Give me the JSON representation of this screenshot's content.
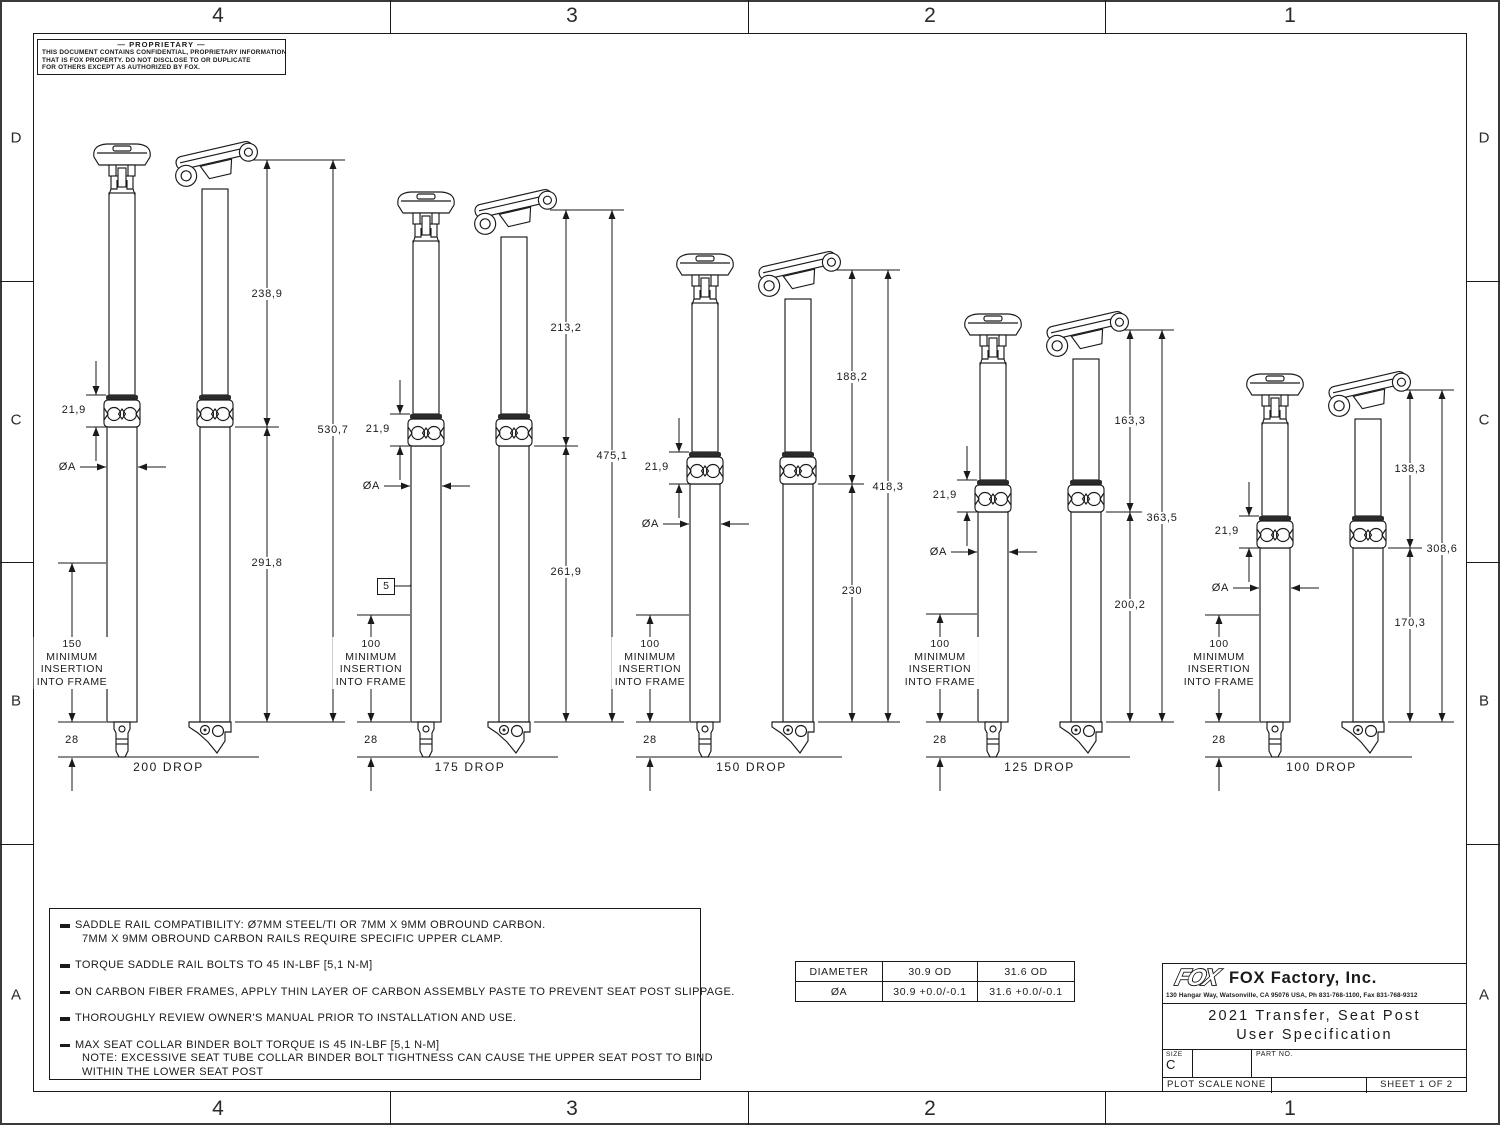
{
  "zones": {
    "top": [
      "4",
      "3",
      "2",
      "1"
    ],
    "bottom": [
      "4",
      "3",
      "2",
      "1"
    ],
    "left": [
      "D",
      "C",
      "B",
      "A"
    ],
    "right": [
      "D",
      "C",
      "B",
      "A"
    ]
  },
  "proprietary": {
    "title": "— PROPRIETARY —",
    "lines": [
      "THIS DOCUMENT CONTAINS CONFIDENTIAL, PROPRIETARY INFORMATION",
      "THAT IS FOX PROPERTY.  DO NOT DISCLOSE TO OR DUPLICATE",
      "FOR OTHERS EXCEPT AS AUTHORIZED BY FOX."
    ]
  },
  "posts": [
    {
      "drop_label": "200 DROP",
      "dim_upper": "238,9",
      "dim_total": "530,7",
      "dim_lower": "291,8",
      "dim_collar": "21,9",
      "dim_diameter": "ØA",
      "dim_bottom": "28",
      "insertion_lines": [
        "150",
        "MINIMUM",
        "INSERTION",
        "INTO FRAME"
      ]
    },
    {
      "drop_label": "175 DROP",
      "dim_upper": "213,2",
      "dim_total": "475,1",
      "dim_lower": "261,9",
      "dim_collar": "21,9",
      "dim_diameter": "ØA",
      "dim_bottom": "28",
      "insertion_lines": [
        "100",
        "MINIMUM",
        "INSERTION",
        "INTO FRAME"
      ],
      "flag_note": "5"
    },
    {
      "drop_label": "150 DROP",
      "dim_upper": "188,2",
      "dim_total": "418,3",
      "dim_lower": "230",
      "dim_collar": "21,9",
      "dim_diameter": "ØA",
      "dim_bottom": "28",
      "insertion_lines": [
        "100",
        "MINIMUM",
        "INSERTION",
        "INTO FRAME"
      ]
    },
    {
      "drop_label": "125 DROP",
      "dim_upper": "163,3",
      "dim_total": "363,5",
      "dim_lower": "200,2",
      "dim_collar": "21,9",
      "dim_diameter": "ØA",
      "dim_bottom": "28",
      "insertion_lines": [
        "100",
        "MINIMUM",
        "INSERTION",
        "INTO FRAME"
      ]
    },
    {
      "drop_label": "100 DROP",
      "dim_upper": "138,3",
      "dim_total": "308,6",
      "dim_lower": "170,3",
      "dim_collar": "21,9",
      "dim_diameter": "ØA",
      "dim_bottom": "28",
      "insertion_lines": [
        "100",
        "MINIMUM",
        "INSERTION",
        "INTO FRAME"
      ]
    }
  ],
  "notes": [
    {
      "lines": [
        "SADDLE RAIL COMPATIBILITY: Ø7MM STEEL/TI OR 7MM X 9MM OBROUND CARBON.",
        "7MM X 9MM OBROUND CARBON RAILS REQUIRE SPECIFIC UPPER CLAMP."
      ]
    },
    {
      "lines": [
        "TORQUE SADDLE RAIL BOLTS TO 45 IN-LBF [5,1 N-M]"
      ]
    },
    {
      "lines": [
        "ON CARBON FIBER FRAMES, APPLY THIN LAYER OF CARBON ASSEMBLY PASTE TO PREVENT SEAT POST SLIPPAGE."
      ]
    },
    {
      "lines": [
        "THOROUGHLY REVIEW OWNER'S MANUAL PRIOR TO INSTALLATION AND USE."
      ]
    },
    {
      "lines": [
        "MAX SEAT COLLAR BINDER BOLT TORQUE IS 45 IN-LBF [5,1 N-M]",
        "NOTE: EXCESSIVE SEAT TUBE COLLAR BINDER BOLT TIGHTNESS CAN CAUSE THE UPPER SEAT POST TO BIND",
        "WITHIN THE LOWER SEAT POST"
      ]
    }
  ],
  "diameter_table": {
    "headers": [
      "DIAMETER",
      "30.9 OD",
      "31.6 OD"
    ],
    "row": [
      "ØA",
      "30.9 +0.0/-0.1",
      "31.6 +0.0/-0.1"
    ]
  },
  "title_block": {
    "logo": "FOX",
    "company": "FOX Factory, Inc.",
    "address": "130 Hangar Way, Watsonville, CA 95076 USA, Ph 831-768-1100, Fax 831-768-9312",
    "title_line1": "2021 Transfer, Seat Post",
    "title_line2": "User Specification",
    "size_label": "SIZE",
    "size_value": "C",
    "part_no_label": "PART NO.",
    "plot_scale_label": "PLOT SCALE",
    "plot_scale_value": "NONE",
    "sheet_label": "SHEET 1 OF 2"
  }
}
